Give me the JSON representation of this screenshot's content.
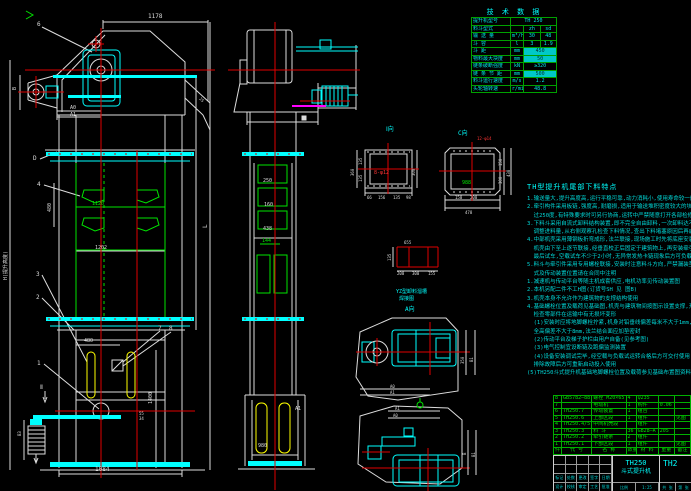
{
  "colors": {
    "bg": "#000000",
    "cyan": "#00ffff",
    "green": "#00e400",
    "red": "#ff3434",
    "yellow": "#ffff00",
    "magenta": "#ff00ff",
    "white": "#dcdcdc",
    "table_green": "#00b000"
  },
  "left_view": {
    "dim_top": "1178",
    "dim_b": "B",
    "label_6": "6",
    "dim_a0": "A0",
    "dim_a1": "A1",
    "dim_25": "25",
    "label_d": "D",
    "label_4": "4",
    "dim_480_mid": "480",
    "dim_1120": "1120",
    "dim_1202": "1202",
    "label_3": "3",
    "label_2": "2",
    "label_7": "7",
    "label_8": "8",
    "label_1": "1",
    "sect_ii": "Ⅱ",
    "dim_480_boot": "480",
    "dim_55": "55",
    "dim_34": "34",
    "dim_1400": "1400",
    "dim_b3": "B3",
    "dim_1084": "1084",
    "dim_h": "H(提升高度)",
    "dim_l": "L"
  },
  "mid_view": {
    "dim_250": "250",
    "dim_160": "160",
    "dim_438": "438",
    "dim_144": "144",
    "dim_a1": "A1",
    "dim_980": "980"
  },
  "detail_i": {
    "label": "Ⅰ向",
    "holes": "8-φ12",
    "dim_left": "360",
    "dim_135a": "135",
    "dim_135b": "135",
    "dim_right": "300",
    "dim_b1": "66",
    "dim_b2": "156",
    "dim_b3": "135",
    "dim_b4": "98"
  },
  "detail_c": {
    "label": "C向",
    "holes": "12-φ14",
    "dim_center": "988",
    "dim_r1": "150",
    "dim_r2": "300",
    "dim_rt": "438",
    "dim_b1": "150",
    "dim_b2": "200",
    "dim_bt": "478"
  },
  "grid_detail": {
    "dim_top": "655",
    "dim_left": "135",
    "dim_b1": "200",
    "dim_b2": "300",
    "dim_b3": "155",
    "caption1": "YZ型卸料溜槽",
    "caption2": "焊接图",
    "view_label": "A向"
  },
  "plan_head": {
    "dim_350": "350",
    "dim_b1": "B1",
    "dim_a0": "A0",
    "dim_a1": "A1"
  },
  "plan_boot": {
    "dim_a1": "A1",
    "dim_a0": "A0",
    "dim_b": "B",
    "dim_b1": "B1"
  },
  "tech_table": {
    "title": "技 术 数 据",
    "rows": [
      {
        "label": "提升机型号",
        "unit": "",
        "v1": "TH 250",
        "v2": ""
      },
      {
        "label": "料斗型式",
        "unit": "",
        "v1": "zh",
        "v2": "sd"
      },
      {
        "label": "输 送 量",
        "unit": "m³/h",
        "v1": "30",
        "v2": "48"
      },
      {
        "label": "斗  容",
        "unit": "l",
        "v1": "3",
        "v2": "1.9"
      },
      {
        "label": "斗  距",
        "unit": "mm",
        "v1": "450",
        "v2": ""
      },
      {
        "label": "物料最大块度",
        "unit": "mm",
        "v1": "50",
        "v2": ""
      },
      {
        "label": "链条破断强度",
        "unit": "kN",
        "v1": "≥320",
        "v2": ""
      },
      {
        "label": "链 条 节 距",
        "unit": "mm",
        "v1": "500",
        "v2": ""
      },
      {
        "label": "料斗运行速度",
        "unit": "m/s",
        "v1": "1.2",
        "v2": ""
      },
      {
        "label": "头轮轴转速",
        "unit": "r/min",
        "v1": "48.8",
        "v2": ""
      }
    ]
  },
  "notes": {
    "title": "TH型提升机尾部下料特点",
    "lines": [
      "1.输送量大,提升高度高,运行平稳可靠,动力消耗小,使用寿命较一般为长",
      "2.牵引构件采用板链,强度高,耐磨损,适用于输送堆积密度较大的块状粒状物料,物料温度一般不超",
      "  过250度,有特殊要求时可另行协商,运转中严禁随意打开各部检修门",
      "3.下料斗采用自流式卸料结构装置,即不完全自由卸料,一次卸料达不到标准时,方可",
      "  调整进料量,从右侧观察孔检查下料情况,查出下料堵塞原因后再启动",
      "4.中部机壳采用薄钢板折弯成形,法兰联接,现场施工时先将底座安装在基础上,找正找平后灌浆固定,",
      "  机壳由下至上逐节联接,经垂直校正后固定于建筑物上,再安装牵引件及料斗,调整链条张紧装置,",
      "  最后试车,空载试车不少于2小时,无异常发热卡链现象后方可负载运转",
      "5.料斗与牵引件采用专用螺栓联接,安装时注意料斗方向,严禁漏装垫圈      订货时如需改变卸料方",
      "  式及传动装置位置请在合同中注明",
      "1.减速机与传动平台等随主机成套供应,电机功率见传动装置图",
      "2.本机另配二件不工H图(订货号SH 见 图B)",
      "3.机壳本身不允许作为建筑物的支撑结构使用",
      "4.基础螺栓位置及载荷见基础图,机壳与建筑物间按图示设置支撑,开箱后请核对装箱单,",
      "  检查零部件在运输中有无损坏变形",
      "  (1)安装时应将地脚螺栓拧紧,机身对铅垂线偏差每米不大于1mm,",
      "  全高偏差不大于8mm,法兰结合面应加垫密封",
      "  (2)传动平台及梯子护栏由用户自备(见参考图)",
      "  (3)电气控制宜设断链及跑偏监测装置",
      "  (4)设备安装调试完毕,经空载与负载试运转合格后方可交付使用,运转中如有异响应立即停机,",
      "  排除故障后方可重新启动投入使用",
      "",
      "(5)TH250斗式提升机基础地脚螺栓位置及载荷参见基础布置图资料."
    ]
  },
  "bom": {
    "headers": [
      "件号",
      "代  号",
      "名  称",
      "数量",
      "材 料",
      "重量",
      "备注"
    ],
    "rows": [
      {
        "no": "8",
        "code": "GB5782—88",
        "name": "螺栓 M20×65",
        "qty": "4",
        "mat": "Q235",
        "wt": "",
        "note": ""
      },
      {
        "no": "7",
        "code": "",
        "name": "电动机",
        "qty": "1",
        "mat": "购件",
        "wt": "0.06",
        "note": ""
      },
      {
        "no": "6",
        "code": "TH250.7",
        "name": "传动装置",
        "qty": "1",
        "mat": "组合",
        "wt": "",
        "note": ""
      },
      {
        "no": "5",
        "code": "TH250.6",
        "name": "上部区段",
        "qty": "1",
        "mat": "组件",
        "wt": "",
        "note": "见图"
      },
      {
        "no": "4",
        "code": "TH250.4/5",
        "name": "中间机壳段",
        "qty": "",
        "mat": "组件",
        "wt": "",
        "note": ""
      },
      {
        "no": "3",
        "code": "TH250.3",
        "name": "料  斗",
        "qty": "36",
        "mat": "GB28—A",
        "wt": "205",
        "note": ""
      },
      {
        "no": "2",
        "code": "TH250.2",
        "name": "牵引链条",
        "qty": "2",
        "mat": "组件",
        "wt": "",
        "note": ""
      },
      {
        "no": "1",
        "code": "TH250.1",
        "name": "下部区段",
        "qty": "1",
        "mat": "组件",
        "wt": "",
        "note": "见图"
      }
    ]
  },
  "title_block": {
    "model": "TH250",
    "product": "斗式提升机",
    "right_code": "TH2",
    "rev_row1": [
      "标记",
      "处数",
      "更改文件号",
      "签字",
      "日期"
    ],
    "rev_row2": [
      "设计",
      "校核",
      "审定",
      "工艺",
      "批准"
    ],
    "mid_cells": [
      "比例",
      "1:25"
    ],
    "rt_cells": [
      "共 张",
      "第 张"
    ]
  }
}
